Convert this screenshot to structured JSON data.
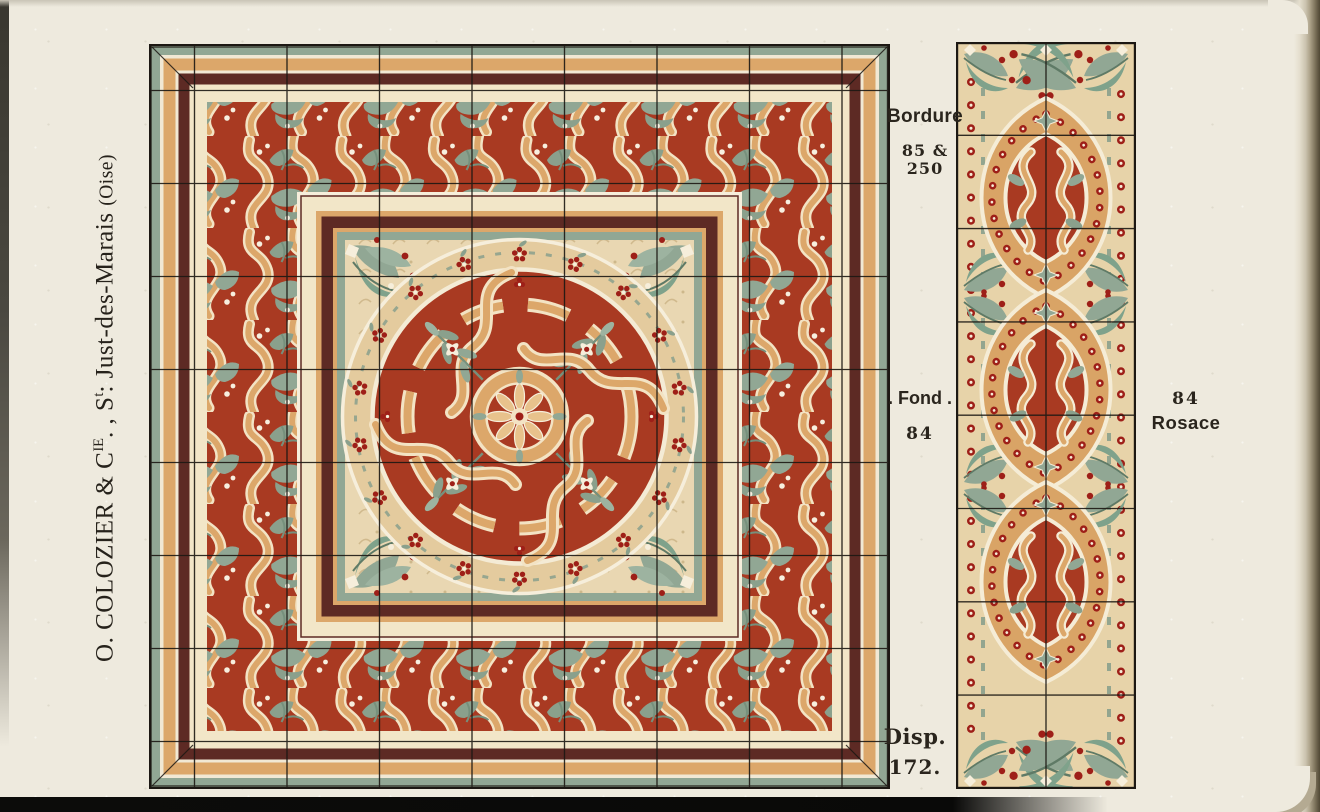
{
  "publisher": {
    "part1": "O. COLOZIER & C",
    "sup1": "IE",
    "part2": ". , S",
    "sup2": "t",
    "part3": ": Just-des-Marais ",
    "part4": "(Oise)"
  },
  "labels": {
    "bordure": {
      "title": "Bordure",
      "ref": "85 & 250"
    },
    "fond": {
      "title": ". Fond .",
      "ref": "84"
    },
    "disp": {
      "title": "Disp.",
      "ref": "172."
    },
    "rosace": {
      "ref": "84",
      "title": "Rosace"
    }
  },
  "colors": {
    "page": "#eeeade",
    "red": "#a93a22",
    "berry": "#9e1f18",
    "sage": "#91a794",
    "sage-dark": "#76907c",
    "ochre": "#dca76a",
    "tan-light": "#e8c28c",
    "maroon": "#5d2a24",
    "cream": "#f3e9d2",
    "cream-band": "#f2e6c8",
    "field-tan": "#e9d7b2",
    "ink": "#1c1813",
    "bar": "#0c0c0a"
  }
}
